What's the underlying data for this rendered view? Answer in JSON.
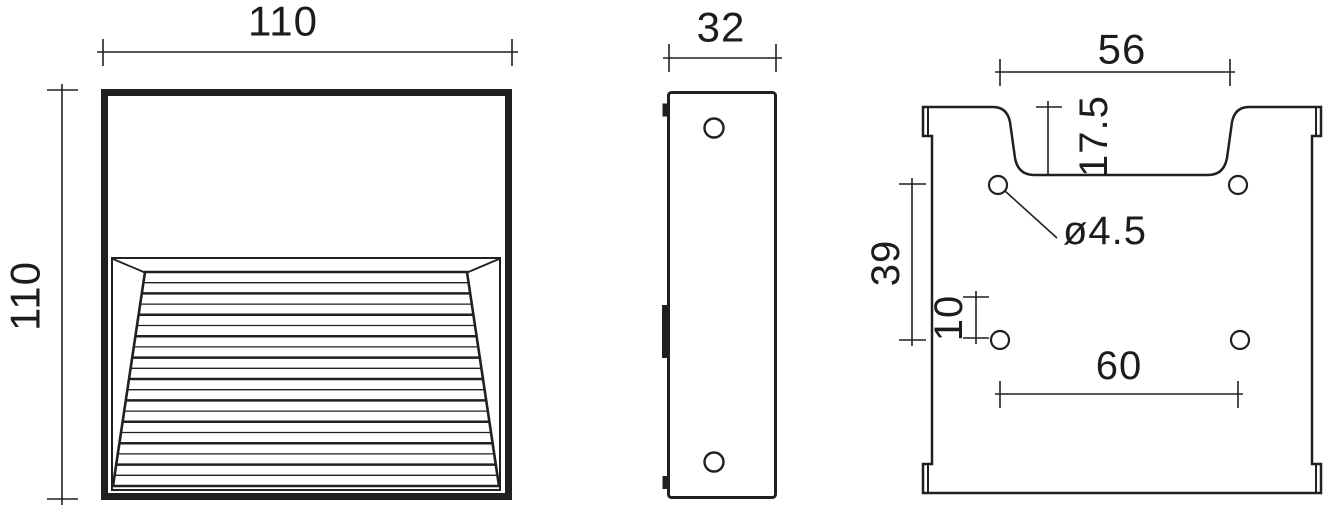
{
  "drawing": {
    "views": {
      "front": {
        "width_mm": "110",
        "height_mm": "110"
      },
      "side": {
        "depth_mm": "32"
      },
      "back": {
        "slot_width_mm": "56",
        "slot_depth_mm": "17.5",
        "hole_diameter": "ø4.5",
        "hole_row_spacing_mm": "39",
        "row_center_offset_mm": "10",
        "hole_column_spacing_mm": "60"
      }
    },
    "line_color": "#221f20",
    "background_color": "#ffffff"
  }
}
